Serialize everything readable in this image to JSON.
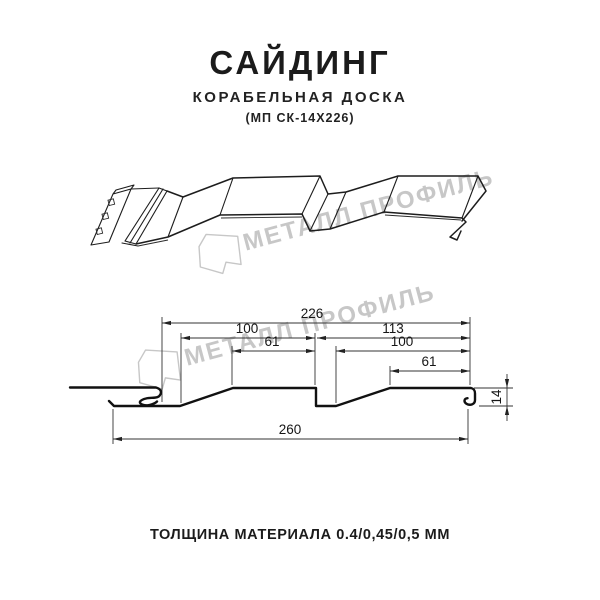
{
  "header": {
    "title": "САЙДИНГ",
    "subtitle": "КОРАБЕЛЬНАЯ ДОСКА",
    "model_code": "(МП СК-14Х226)"
  },
  "watermark": {
    "text": "МЕТАЛЛ ПРОФИЛЬ",
    "color": "#c7c7c7",
    "logo_icon": "metall-profil-pentagon-logo"
  },
  "section": {
    "dim_overall": "226",
    "dim_left_pitch": "100",
    "dim_left_crest": "61",
    "dim_right_span": "113",
    "dim_right_pitch": "100",
    "dim_right_crest": "61",
    "dim_total_width": "260",
    "dim_height": "14"
  },
  "footer": {
    "thickness_label": "ТОЛЩИНА МАТЕРИАЛА 0.4/0,45/0,5 ММ"
  },
  "canvas": {
    "background": "#ffffff",
    "line_color": "#1a1a1a"
  }
}
